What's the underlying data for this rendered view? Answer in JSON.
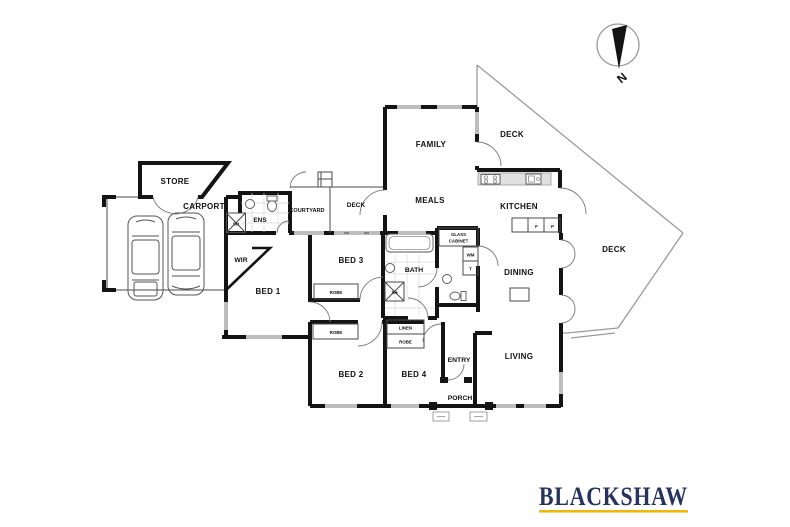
{
  "labels": {
    "store": "STORE",
    "carport": "CARPORT",
    "ens": "ENS",
    "courtyard": "COURTYARD",
    "deck_mid": "DECK",
    "deck_top": "DECK",
    "deck_right": "DECK",
    "family": "FAMILY",
    "meals": "MEALS",
    "kitchen": "KITCHEN",
    "glass_cabinet_1": "GLASS",
    "glass_cabinet_2": "CABINET",
    "wm": "WM",
    "t": "T",
    "f": "F",
    "p": "P",
    "dining": "DINING",
    "living": "LIVING",
    "entry": "ENTRY",
    "porch": "PORCH",
    "wir": "WIR",
    "bed1": "BED 1",
    "bed2": "BED 2",
    "bed3": "BED 3",
    "bed4": "BED 4",
    "bath": "BATH",
    "robe_bed3": "ROBE",
    "robe_bed2": "ROBE",
    "linen": "LINEN",
    "robe_bed4": "ROBE",
    "sh_ens": "SH",
    "sh_bath": "SH",
    "north": "N"
  },
  "logo": {
    "name": "BLACKSHAW",
    "text_color": "#27335f",
    "underline_color": "#f0b70a"
  },
  "colors": {
    "wall": "#141414",
    "window": "#bdbdbd",
    "deck_line": "#9a9a9a",
    "background": "#ffffff"
  }
}
